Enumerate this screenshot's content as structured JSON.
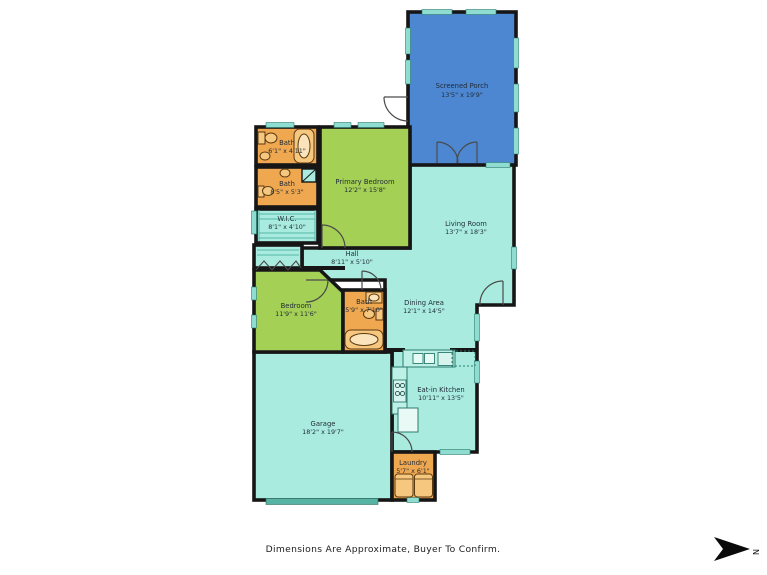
{
  "title": "Floor Plan",
  "footer": {
    "disclaimer": "Dimensions Are Approximate, Buyer To Confirm."
  },
  "compass": {
    "label": "N"
  },
  "colors": {
    "porch": "#4d87d1",
    "open_area": "#a9ecdf",
    "bedroom_green": "#a4d055",
    "bath_orange": "#f0a850",
    "wall": "#161616",
    "window": "#8fdcd0",
    "garage_door": "#57b3a4"
  },
  "rooms": [
    {
      "id": "screened-porch",
      "name": "Screened Porch",
      "dims": "13'5\" x 19'9\""
    },
    {
      "id": "bath-upper",
      "name": "Bath",
      "dims": "6'1\" x 4'11\""
    },
    {
      "id": "bath-primary",
      "name": "Bath",
      "dims": "8'5\" x 5'3\""
    },
    {
      "id": "wic",
      "name": "W.I.C.",
      "dims": "8'1\" x 4'10\""
    },
    {
      "id": "primary-bedroom",
      "name": "Primary Bedroom",
      "dims": "12'2\" x 15'8\""
    },
    {
      "id": "hall",
      "name": "Hall",
      "dims": "8'11\" x 5'10\""
    },
    {
      "id": "living-room",
      "name": "Living Room",
      "dims": "13'7\" x 18'3\""
    },
    {
      "id": "dining-area",
      "name": "Dining Area",
      "dims": "12'1\" x 14'5\""
    },
    {
      "id": "bedroom",
      "name": "Bedroom",
      "dims": "11'9\" x 11'6\""
    },
    {
      "id": "bath-hall",
      "name": "Bath",
      "dims": "5'9\" x 7'10\""
    },
    {
      "id": "garage",
      "name": "Garage",
      "dims": "18'2\" x 19'7\""
    },
    {
      "id": "eat-in-kitchen",
      "name": "Eat-in Kitchen",
      "dims": "10'11\" x 13'5\""
    },
    {
      "id": "laundry",
      "name": "Laundry",
      "dims": "5'7\" x 6'1\""
    }
  ]
}
